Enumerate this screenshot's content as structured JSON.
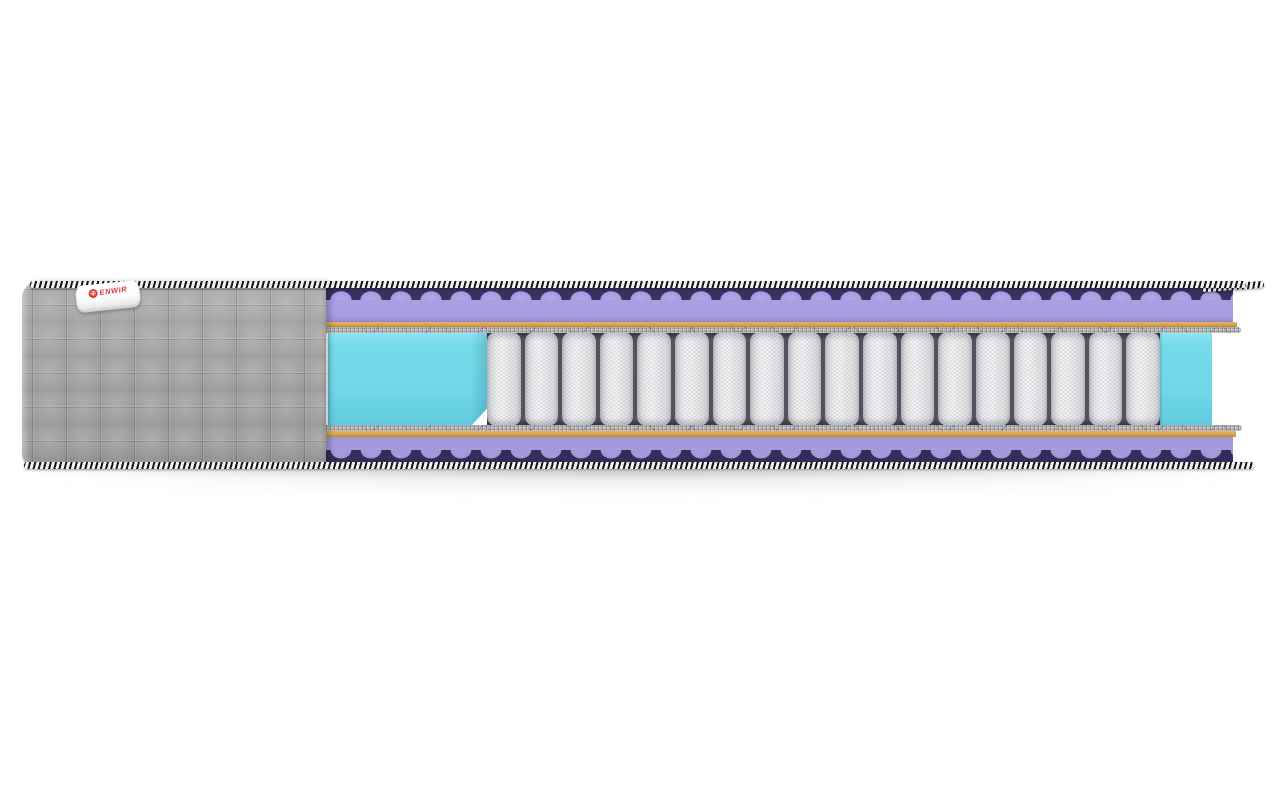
{
  "image": {
    "subject": "mattress cross-section product render",
    "background_color": "#ffffff"
  },
  "brand_label": {
    "logo_letter": "D",
    "name_rest": "ENWIR",
    "full_text": "DENWIR",
    "text_color": "#d93a3a",
    "label_background": "#ffffff"
  },
  "mattress": {
    "cover": {
      "type": "quilted fabric side panel",
      "color": "#9c9c9c",
      "quilt_cell_px": 34
    },
    "edge_tape": {
      "pattern": "diagonal stripes",
      "colors": [
        "#161616",
        "#f2f2f2"
      ]
    },
    "layers_top_to_bottom": [
      {
        "name": "edge-braid-top",
        "style": "black-white striped tape"
      },
      {
        "name": "wave-foam-top",
        "color": "#a89be1",
        "valley_color": "#37315e"
      },
      {
        "name": "coir-layer-top",
        "color": "#d8a44f"
      },
      {
        "name": "felt-pad-top",
        "color": "#b2b1b5"
      },
      {
        "name": "pocket-spring-core",
        "pocket_color": "#eef0f1",
        "gap_color": "#55525f"
      },
      {
        "name": "felt-pad-bottom",
        "color": "#b2b1b5"
      },
      {
        "name": "coir-layer-bottom",
        "color": "#d8a44f"
      },
      {
        "name": "wave-foam-bottom",
        "color": "#a296da",
        "valley_color": "#332d5a"
      },
      {
        "name": "edge-braid-bottom",
        "style": "black-white striped tape"
      }
    ],
    "springs": {
      "count": 18,
      "pocket_color": "#eef0f1"
    },
    "side_support_foam": {
      "color": "#70d8e8"
    }
  }
}
